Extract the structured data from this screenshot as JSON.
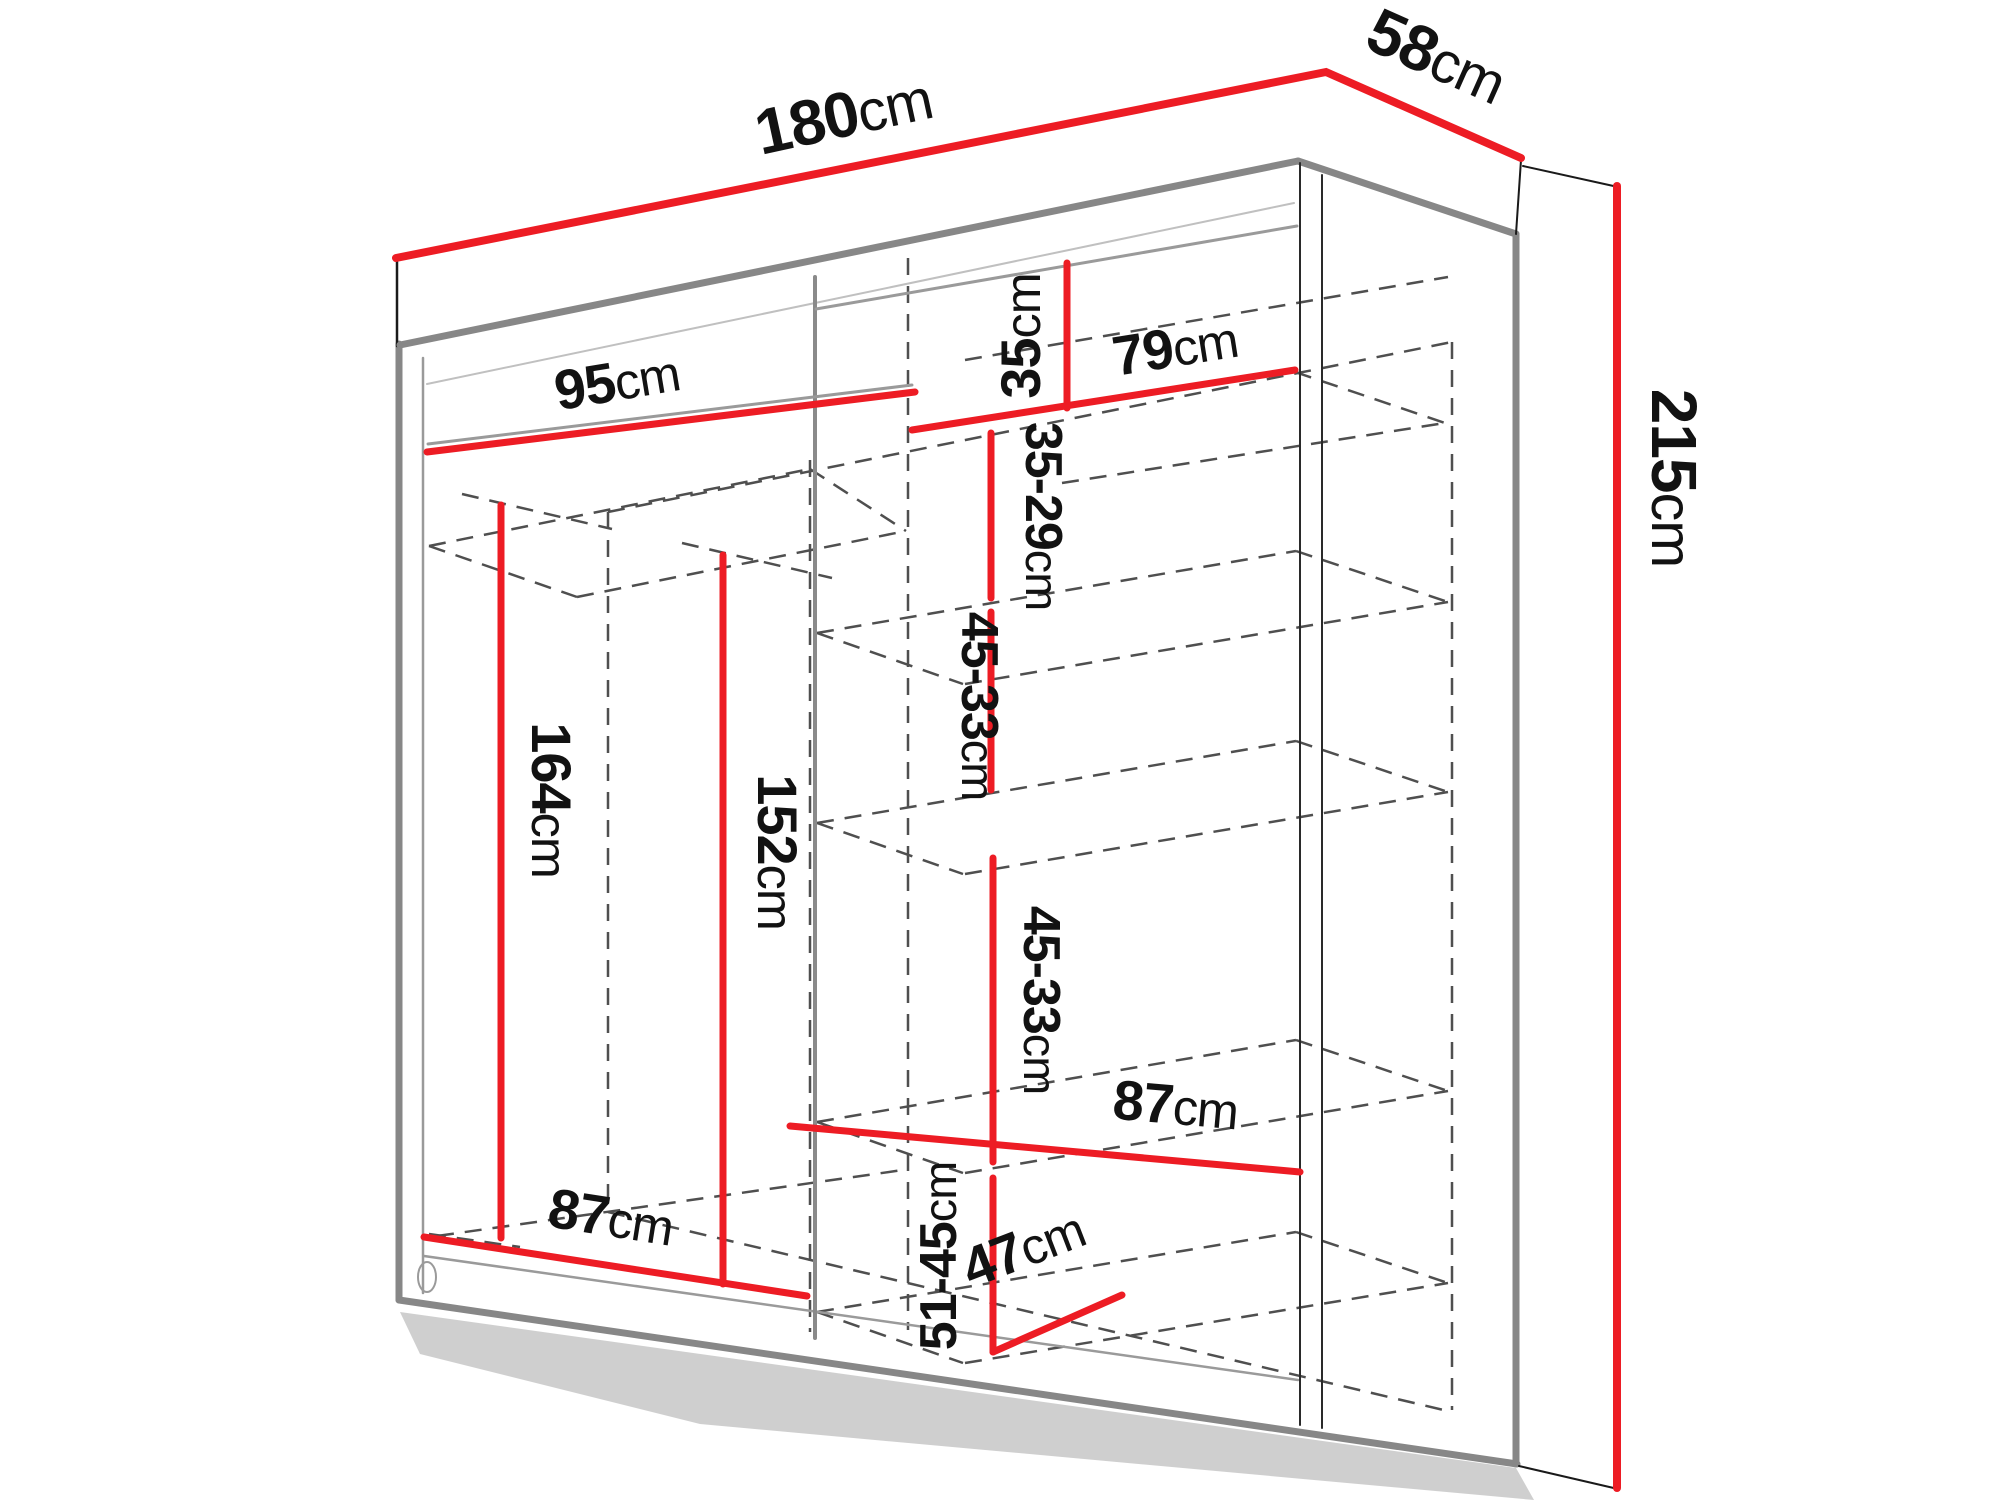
{
  "figure": {
    "kind": "furniture-dimension-diagram",
    "subject": "two-door sliding wardrobe shown in perspective with internal shelf and rail measurements"
  },
  "colors": {
    "dimension": "#ed1c24",
    "structure": "#878787",
    "edge": "#1a1a1a",
    "dashed": "#4f4f4f",
    "text": "#121212",
    "shadow": "#a0a0a0"
  },
  "dims": {
    "width": {
      "value": "180",
      "unit": "cm"
    },
    "depth": {
      "value": "58",
      "unit": "cm"
    },
    "height": {
      "value": "215",
      "unit": "cm"
    },
    "rail_width": {
      "value": "95",
      "unit": "cm"
    },
    "top_gap": {
      "value": "35",
      "unit": "cm"
    },
    "shelf_top_width": {
      "value": "79",
      "unit": "cm"
    },
    "gap_35_29": {
      "value": "35-29",
      "unit": "cm"
    },
    "gap_45_33_upper": {
      "value": "45-33",
      "unit": "cm"
    },
    "gap_45_33_lower": {
      "value": "45-33",
      "unit": "cm"
    },
    "rail_height_left": {
      "value": "164",
      "unit": "cm"
    },
    "rail_height_right": {
      "value": "152",
      "unit": "cm"
    },
    "floor_width_left": {
      "value": "87",
      "unit": "cm"
    },
    "shelf_bottom_width": {
      "value": "87",
      "unit": "cm"
    },
    "gap_51_45": {
      "value": "51-45",
      "unit": "cm"
    },
    "shelf_depth": {
      "value": "47",
      "unit": "cm"
    }
  }
}
